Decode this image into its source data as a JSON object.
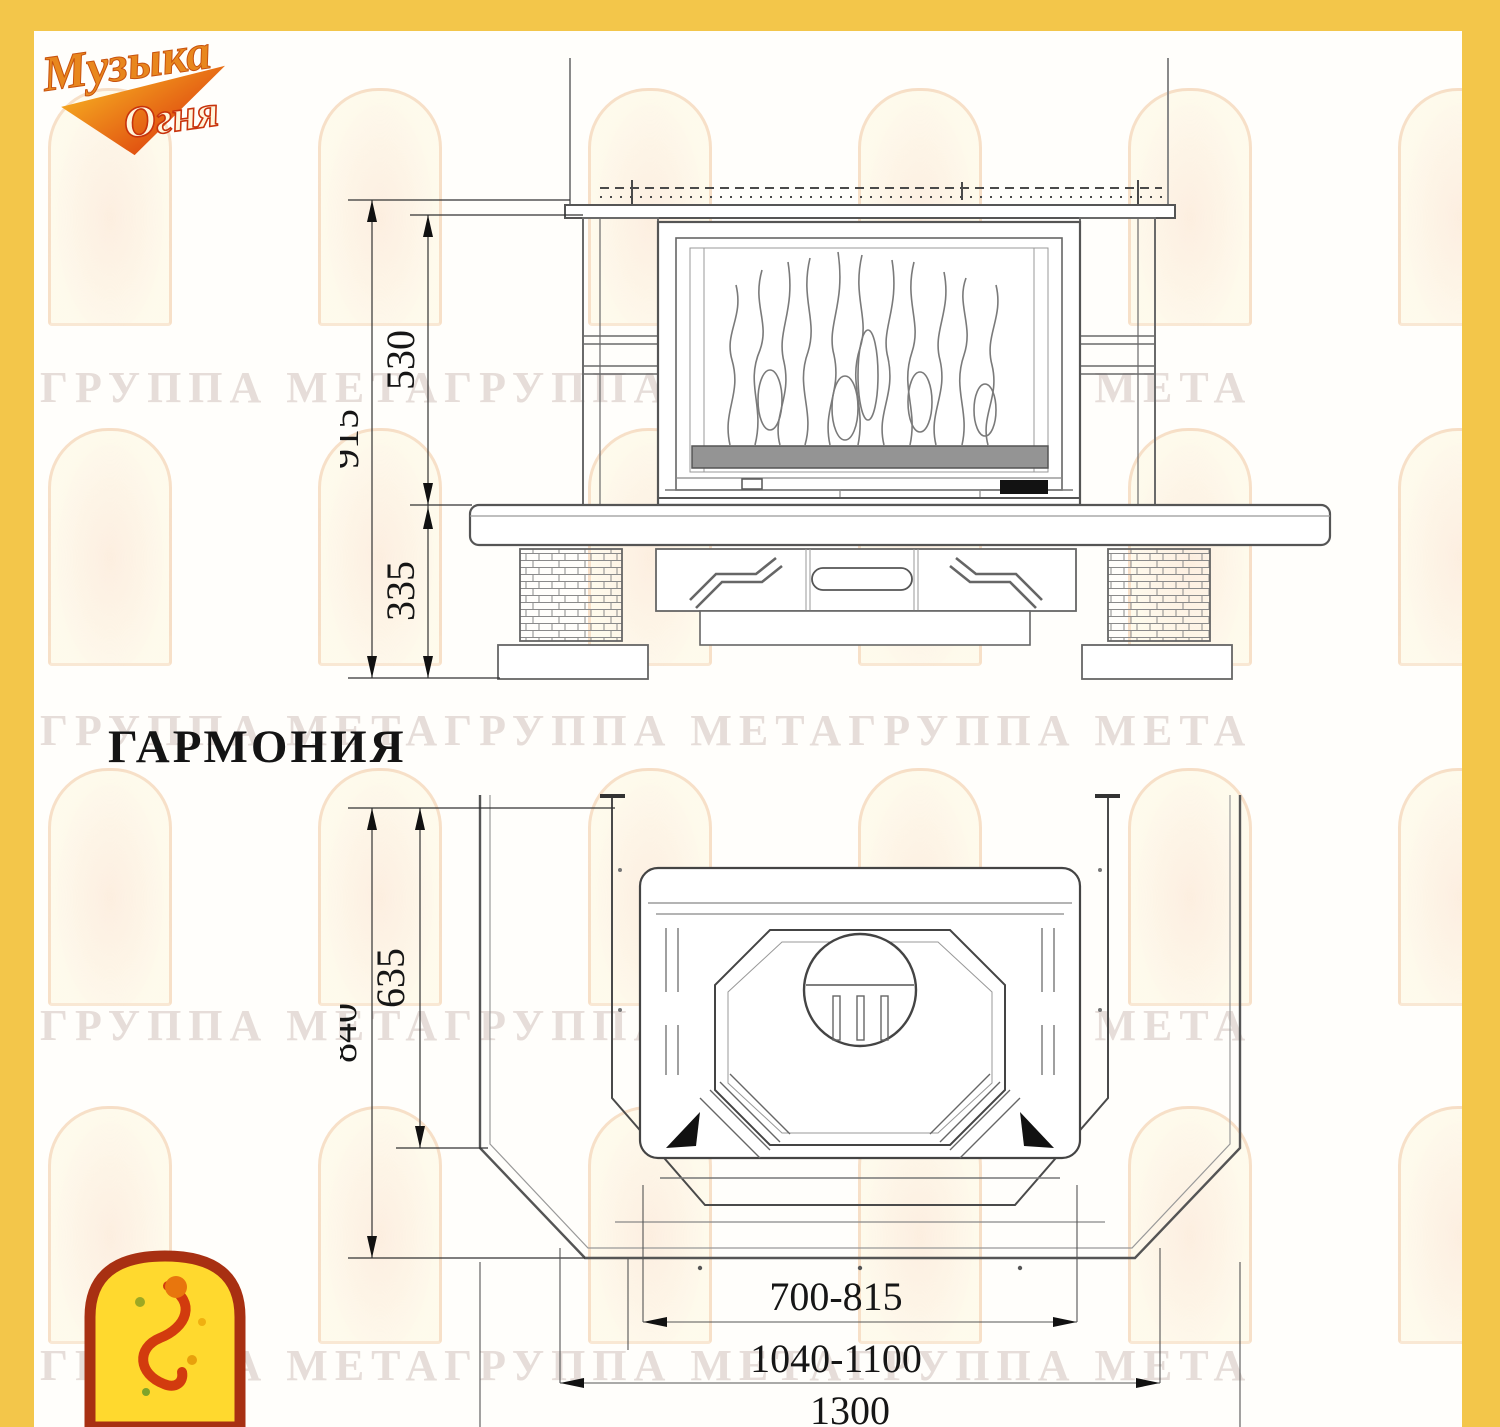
{
  "brand": {
    "logo_word1": "Музыка",
    "logo_word2": "Огня"
  },
  "page": {
    "title": "ГАРМОНИЯ"
  },
  "watermark": {
    "text": "ГРУППА МЕТАГРУППА МЕТАГРУППА МЕТА"
  },
  "front_view": {
    "dim_total_height": "915",
    "dim_firebox_height": "530",
    "dim_base_height": "335"
  },
  "plan_view": {
    "dim_total_depth": "840",
    "dim_inner_depth": "635",
    "dim_opening_width": "700-815",
    "dim_front_width": "1040-1100",
    "dim_total_width": "1300"
  },
  "colors": {
    "frame_yellow": "#F3C64A",
    "emblem_yellow": "#FFD92E",
    "emblem_red": "#A83012",
    "logo_orange": "#E8871E",
    "logo_red": "#D8290A"
  }
}
